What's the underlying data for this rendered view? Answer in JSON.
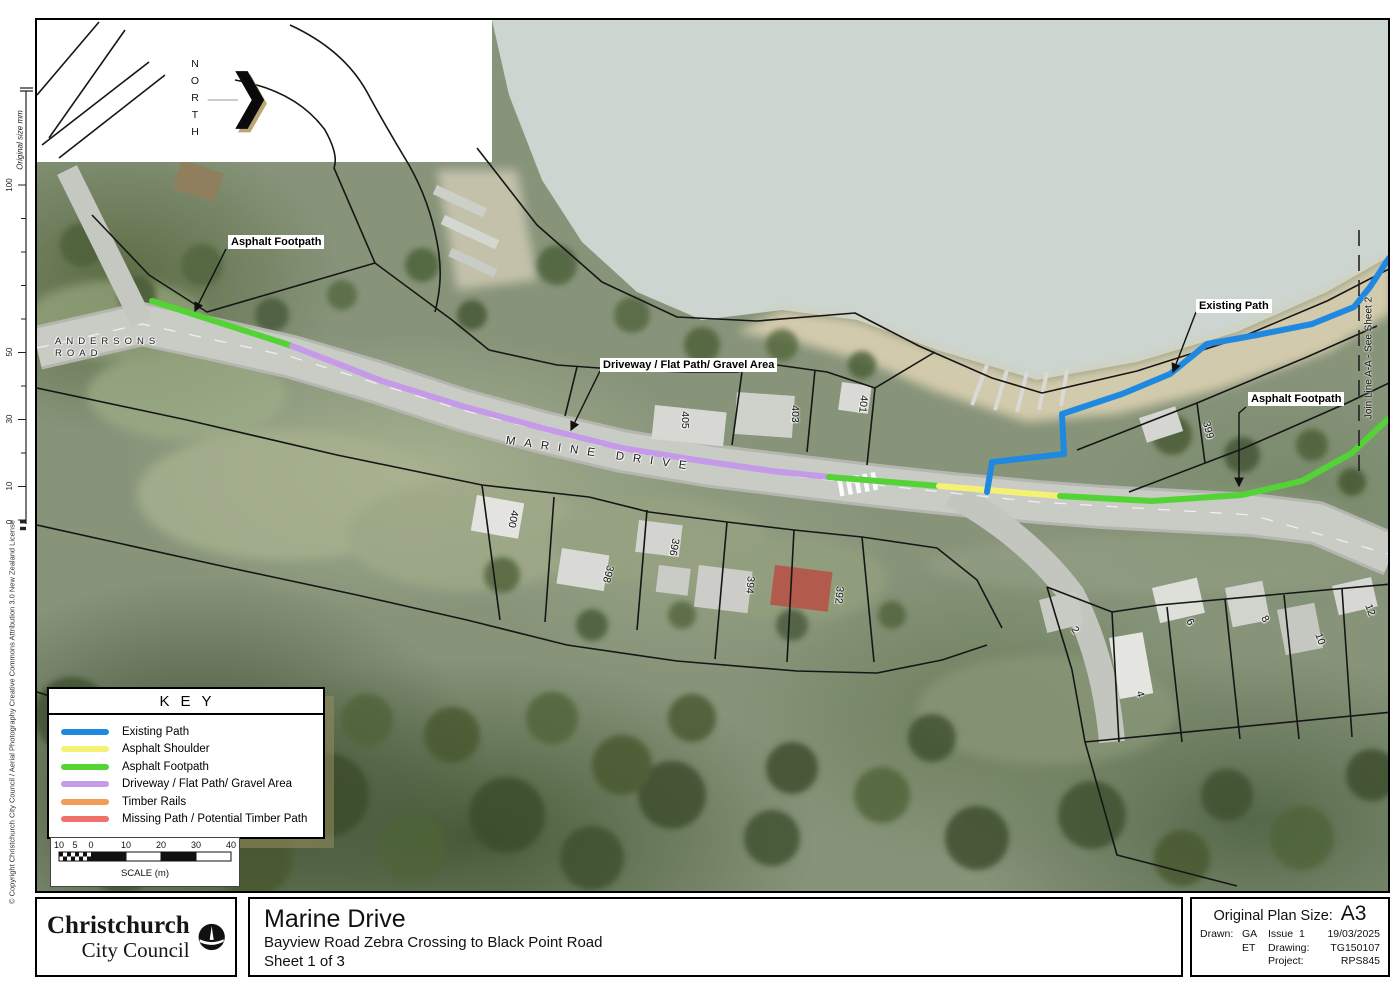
{
  "frame": {
    "ruler_label": "Original size mm",
    "ruler_ticks": [
      "100",
      "50",
      "30",
      "10",
      "0"
    ],
    "copyright": "© Copyright Christchurch City Council / Aerial Photography Creative Commons Attribution 3.0 New Zealand License"
  },
  "map": {
    "north_label": "NORTH",
    "road_labels": {
      "andersons_line1": "ANDERSONS",
      "andersons_line2": "ROAD",
      "marine": "MARINE DRIVE"
    },
    "callouts": {
      "asphalt_footpath_left": "Asphalt Footpath",
      "driveway": "Driveway / Flat Path/ Gravel Area",
      "existing_path": "Existing Path",
      "asphalt_footpath_right": "Asphalt Footpath"
    },
    "join_line": "Join Line A-A - See Sheet 2",
    "parcels": [
      "405",
      "403",
      "401",
      "399",
      "400",
      "398",
      "396",
      "394",
      "392",
      "2",
      "4",
      "6",
      "8",
      "10",
      "12"
    ]
  },
  "key": {
    "title": "KEY",
    "items": [
      {
        "label": "Existing Path",
        "color": "#1f88e0"
      },
      {
        "label": "Asphalt Shoulder",
        "color": "#f5f173"
      },
      {
        "label": "Asphalt Footpath",
        "color": "#54d336"
      },
      {
        "label": "Driveway / Flat Path/ Gravel Area",
        "color": "#c59ae9"
      },
      {
        "label": "Timber Rails",
        "color": "#f29c55"
      },
      {
        "label": "Missing Path / Potential Timber Path",
        "color": "#ef716a"
      }
    ]
  },
  "scale_bar": {
    "labels": [
      "10",
      "5",
      "0",
      "10",
      "20",
      "30",
      "40"
    ],
    "caption": "SCALE (m)"
  },
  "title_block": {
    "org_line1": "Christchurch",
    "org_line2": "City Council",
    "title": "Marine Drive",
    "subtitle": "Bayview Road Zebra Crossing to Black Point Road",
    "sheet": "Sheet 1 of 3",
    "plan_size_label": "Original Plan Size:",
    "plan_size": "A3",
    "drawn_label": "Drawn:",
    "drawn_1": "GA",
    "drawn_2": "ET",
    "issue_label": "Issue",
    "issue_number": "1",
    "issue_date": "19/03/2025",
    "drawing_label": "Drawing:",
    "drawing_number": "TG150107",
    "project_label": "Project:",
    "project_number": "RPS845"
  }
}
